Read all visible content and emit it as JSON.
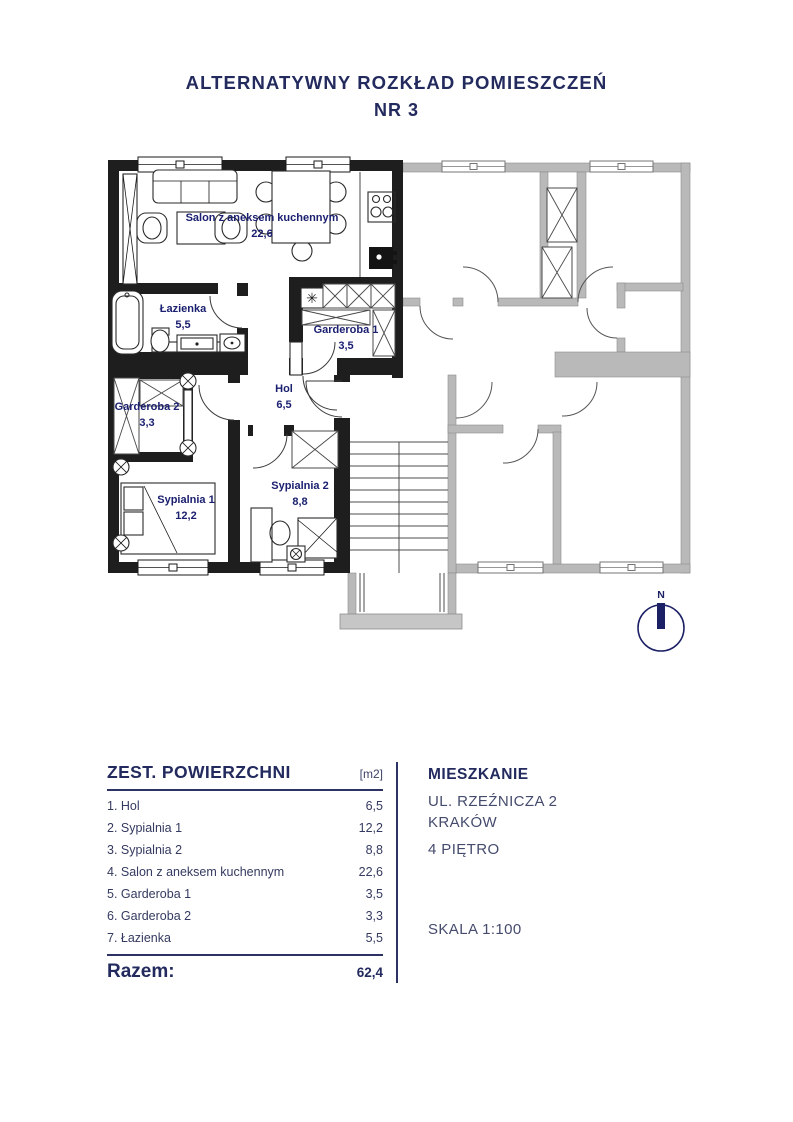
{
  "title": {
    "line1": "ALTERNATYWNY ROZKŁAD POMIESZCZEŃ",
    "line2": "NR 3"
  },
  "plan": {
    "compass": "N",
    "fridge_symbol": "✳",
    "rooms": [
      {
        "name": "Salon z aneksem kuchennym",
        "area": "22,6"
      },
      {
        "name": "Łazienka",
        "area": "5,5"
      },
      {
        "name": "Garderoba 1",
        "area": "3,5"
      },
      {
        "name": "Hol",
        "area": "6,5"
      },
      {
        "name": "Garderoba 2",
        "area": "3,3"
      },
      {
        "name": "Sypialnia 1",
        "area": "12,2"
      },
      {
        "name": "Sypialnia 2",
        "area": "8,8"
      }
    ]
  },
  "area_table": {
    "title": "ZEST. POWIERZCHNI",
    "unit_header": "[m2]",
    "rows": [
      {
        "label": "1. Hol",
        "value": "6,5"
      },
      {
        "label": "2. Sypialnia 1",
        "value": "12,2"
      },
      {
        "label": "3. Sypialnia 2",
        "value": "8,8"
      },
      {
        "label": "4. Salon z aneksem kuchennym",
        "value": "22,6"
      },
      {
        "label": "5. Garderoba 1",
        "value": "3,5"
      },
      {
        "label": "6. Garderoba 2",
        "value": "3,3"
      },
      {
        "label": "7. Łazienka",
        "value": "5,5"
      }
    ],
    "total_label": "Razem:",
    "total_value": "62,4"
  },
  "info": {
    "heading": "MIESZKANIE",
    "address_line1": "UL. RZEŹNICZA 2",
    "address_line2": "KRAKÓW",
    "floor": "4 PIĘTRO",
    "scale": "SKALA 1:100"
  },
  "colors": {
    "navy": "#232a5e",
    "label_navy": "#1b2070",
    "wall_black": "#1e1e1e",
    "wall_gray": "#b9b9b9"
  }
}
